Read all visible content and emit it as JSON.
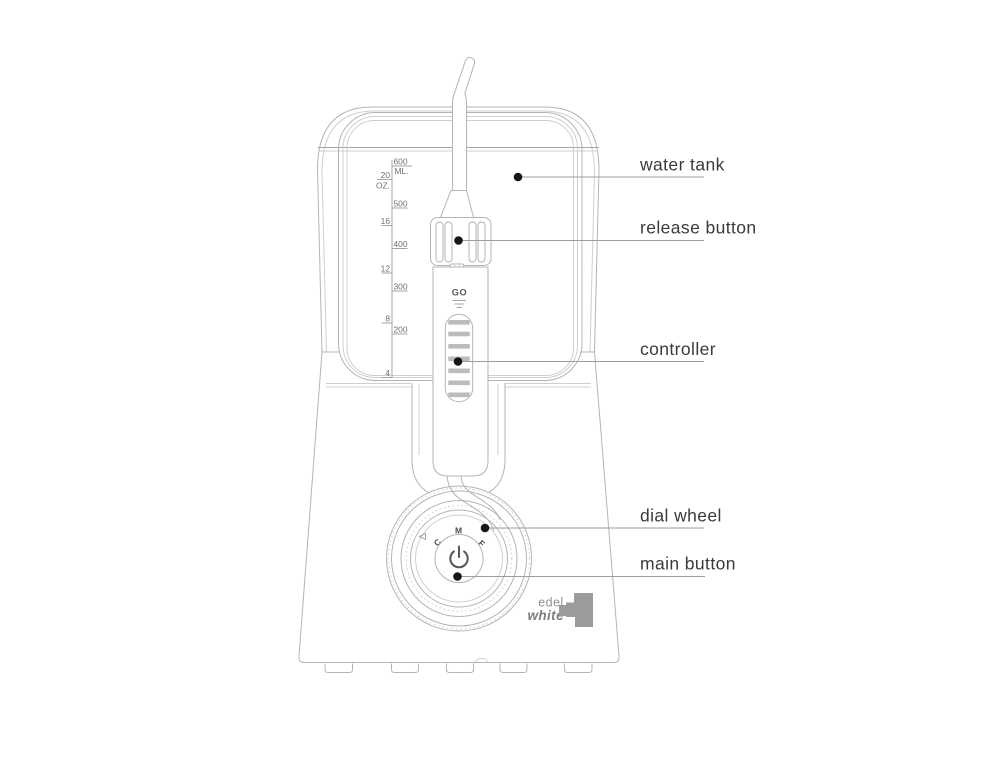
{
  "diagram": {
    "subject": "water flosser parts diagram"
  },
  "callouts": [
    {
      "label": "water tank"
    },
    {
      "label": "release button"
    },
    {
      "label": "controller"
    },
    {
      "label": "dial wheel"
    },
    {
      "label": "main button"
    }
  ],
  "tank_scale": {
    "ml_values": [
      "600",
      "500",
      "400",
      "300",
      "200"
    ],
    "ml_unit": "ML.",
    "oz_values": [
      "20",
      "16",
      "12",
      "8",
      "4"
    ],
    "oz_unit": "OZ."
  },
  "handle": {
    "go_label": "GO"
  },
  "dial": {
    "letter_c": "C",
    "letter_m": "M",
    "letter_f": "F"
  },
  "brand": {
    "word_top": "edel",
    "word_bottom": "white"
  },
  "colors": {
    "outline": "#b4b4b4",
    "leader_line": "#9e9e9e",
    "callout_dot": "#161616",
    "label_text": "#3a3a3a",
    "scale_text": "#6e6e6e",
    "logo_gray": "#9b9b9b",
    "logo_text_top": "#929292",
    "logo_text_bottom": "#7d7d7d"
  }
}
